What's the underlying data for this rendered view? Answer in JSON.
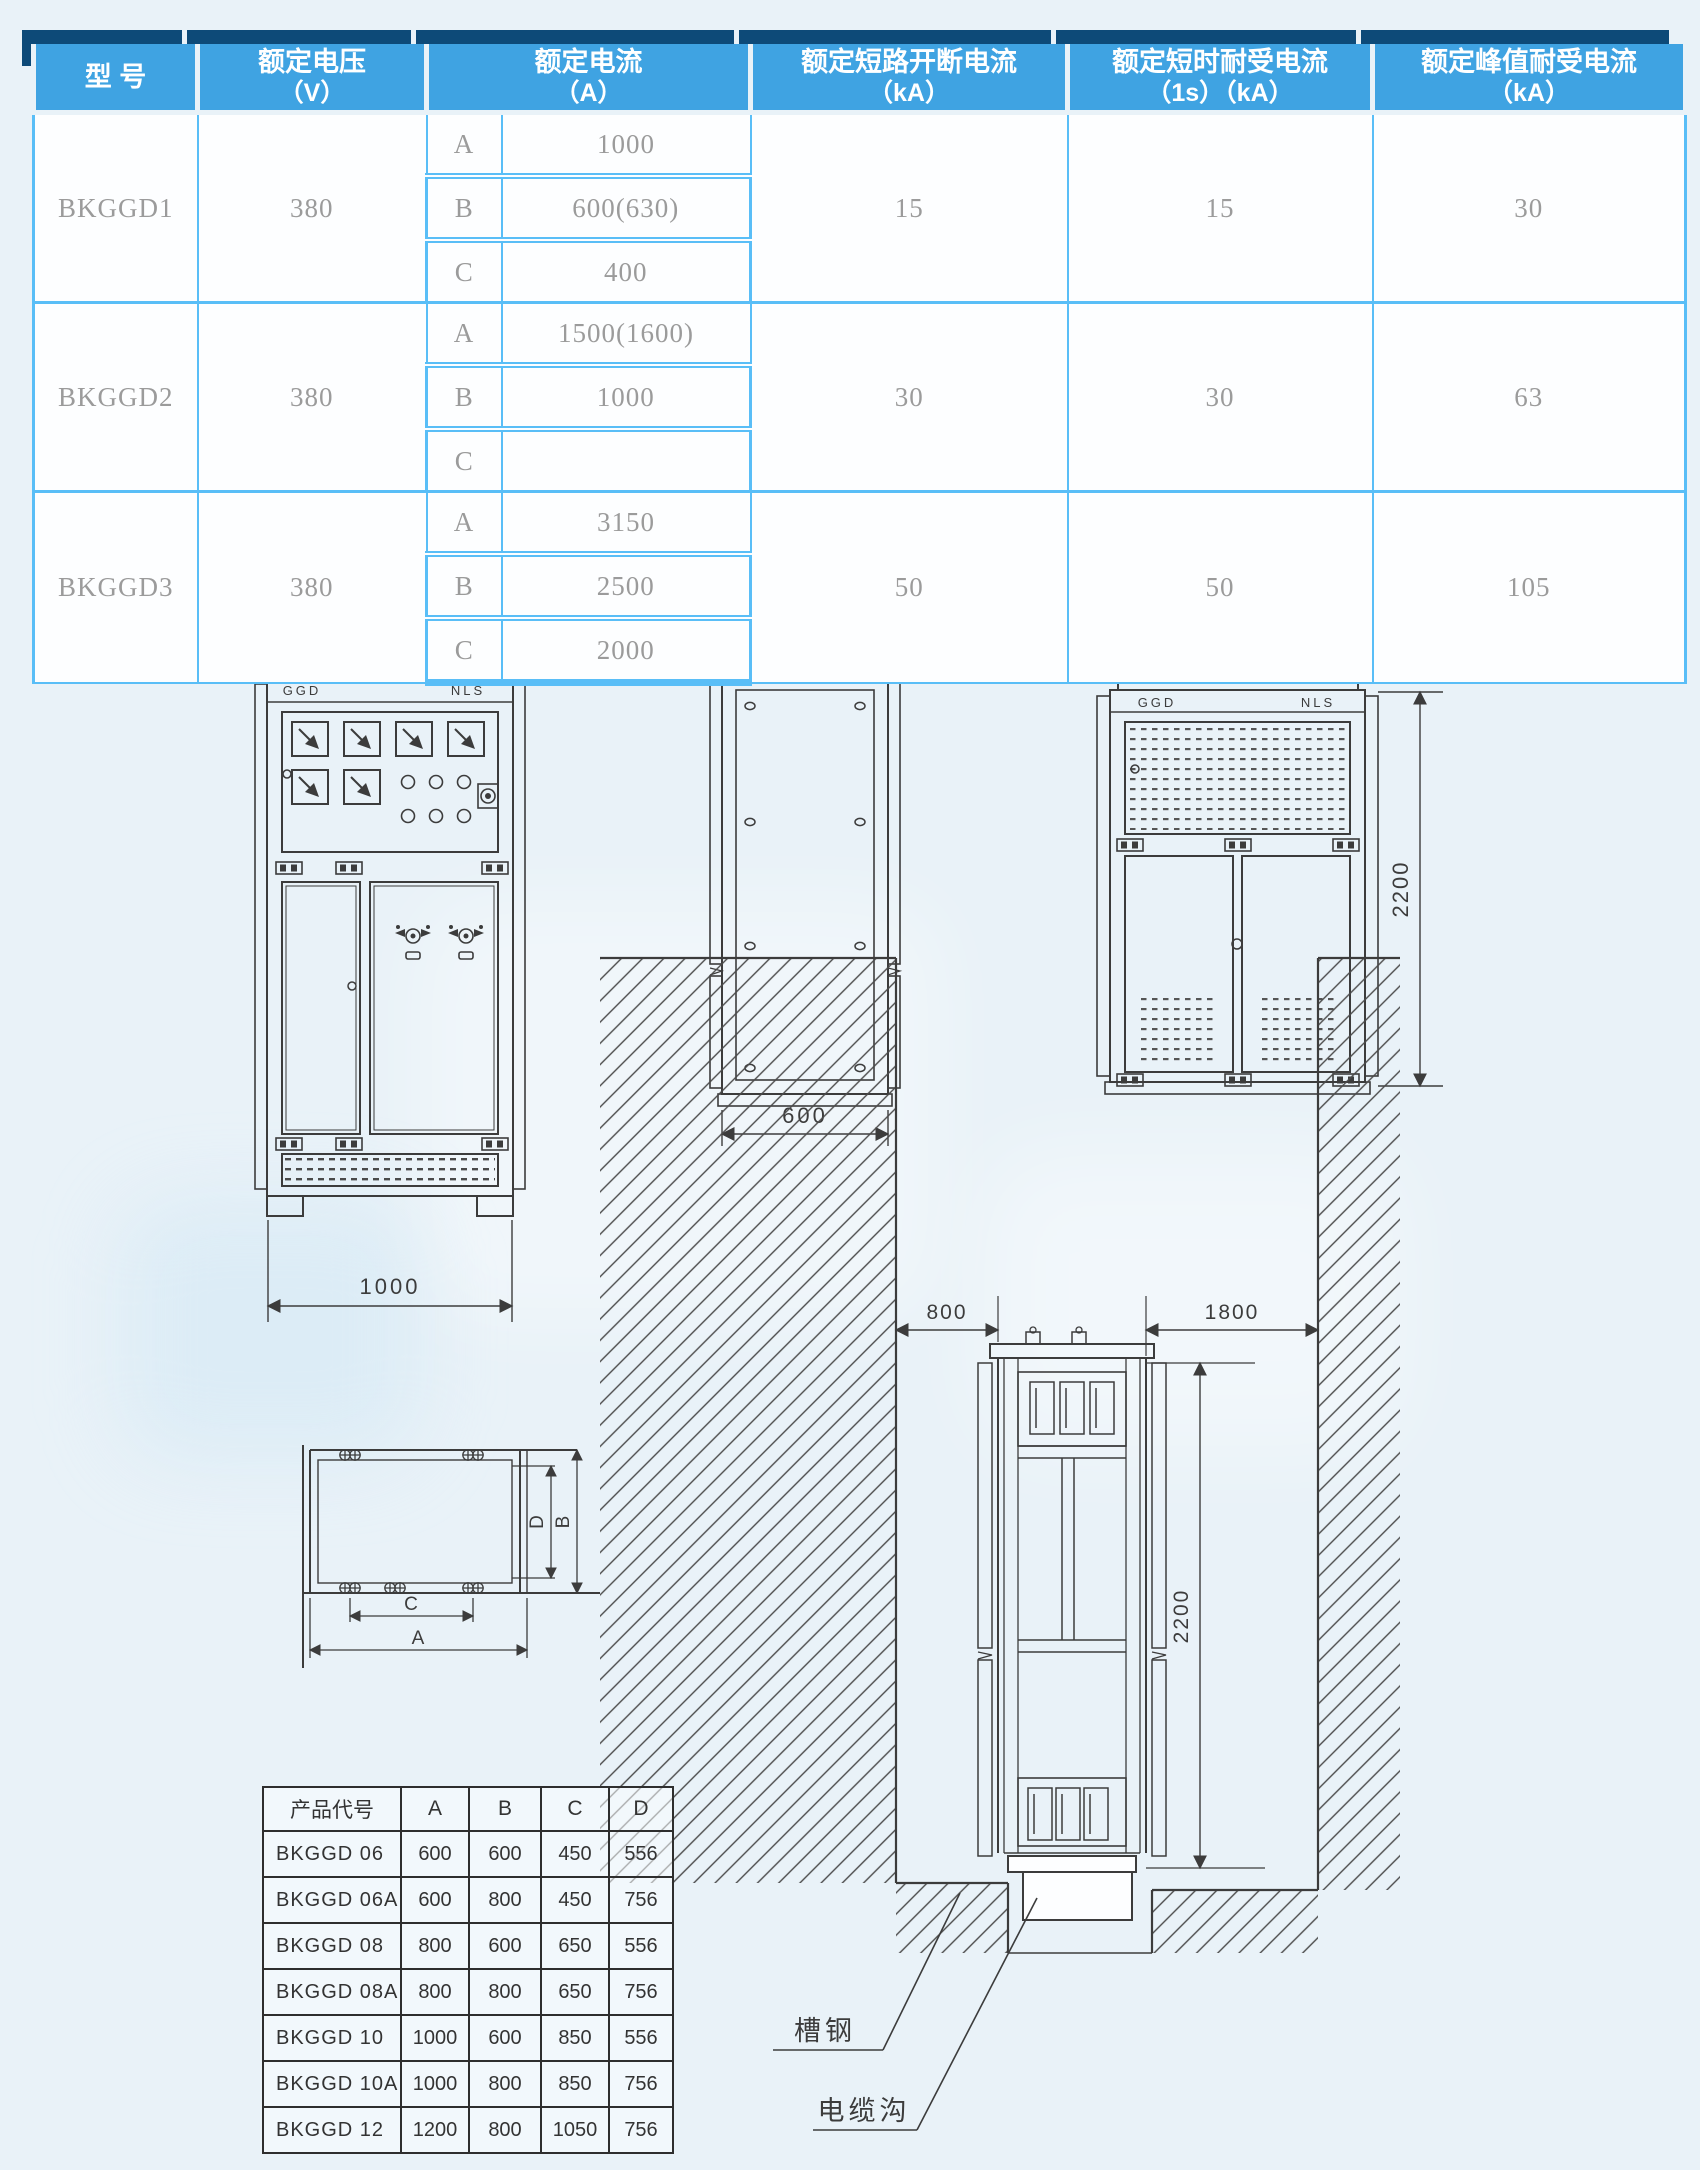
{
  "spec_table": {
    "headers": [
      {
        "l1": "型  号",
        "l2": ""
      },
      {
        "l1": "额定电压",
        "l2": "（V）"
      },
      {
        "l1": "额定电流",
        "l2": "（A）"
      },
      {
        "l1": "额定短路开断电流",
        "l2": "（kA）"
      },
      {
        "l1": "额定短时耐受电流",
        "l2": "（1s）（kA）"
      },
      {
        "l1": "额定峰值耐受电流",
        "l2": "（kA）"
      }
    ],
    "rows": [
      {
        "model": "BKGGD1",
        "voltage": "380",
        "variants": [
          {
            "code": "A",
            "current": "1000"
          },
          {
            "code": "B",
            "current": "600(630)"
          },
          {
            "code": "C",
            "current": "400"
          }
        ],
        "breaking": "15",
        "short_time": "15",
        "peak": "30"
      },
      {
        "model": "BKGGD2",
        "voltage": "380",
        "variants": [
          {
            "code": "A",
            "current": "1500(1600)"
          },
          {
            "code": "B",
            "current": "1000"
          },
          {
            "code": "C",
            "current": ""
          }
        ],
        "breaking": "30",
        "short_time": "30",
        "peak": "63"
      },
      {
        "model": "BKGGD3",
        "voltage": "380",
        "variants": [
          {
            "code": "A",
            "current": "3150"
          },
          {
            "code": "B",
            "current": "2500"
          },
          {
            "code": "C",
            "current": "2000"
          }
        ],
        "breaking": "50",
        "short_time": "50",
        "peak": "105"
      }
    ]
  },
  "drawings": {
    "front_view": {
      "badge_left": "GGD",
      "badge_right": "NLS",
      "width_dim": "1000"
    },
    "side_view": {
      "depth_dim": "600"
    },
    "rear_view": {
      "badge_left": "GGD",
      "badge_right": "NLS",
      "height_dim": "2200"
    },
    "plan_view": {
      "dim_a": "A",
      "dim_b": "B",
      "dim_c": "C",
      "dim_d": "D"
    },
    "installation": {
      "left_clearance_dim": "800",
      "rear_clearance_dim": "1800",
      "height_dim": "2200",
      "channel_steel_label": "槽钢",
      "cable_trench_label": "电缆沟"
    }
  },
  "dimension_table": {
    "headers": [
      "产品代号",
      "A",
      "B",
      "C",
      "D"
    ],
    "rows": [
      [
        "BKGGD 06",
        "600",
        "600",
        "450",
        "556"
      ],
      [
        "BKGGD 06A",
        "600",
        "800",
        "450",
        "756"
      ],
      [
        "BKGGD 08",
        "800",
        "600",
        "650",
        "556"
      ],
      [
        "BKGGD 08A",
        "800",
        "800",
        "650",
        "756"
      ],
      [
        "BKGGD 10",
        "1000",
        "600",
        "850",
        "556"
      ],
      [
        "BKGGD 10A",
        "1000",
        "800",
        "850",
        "756"
      ],
      [
        "BKGGD 12",
        "1200",
        "800",
        "1050",
        "756"
      ]
    ]
  }
}
